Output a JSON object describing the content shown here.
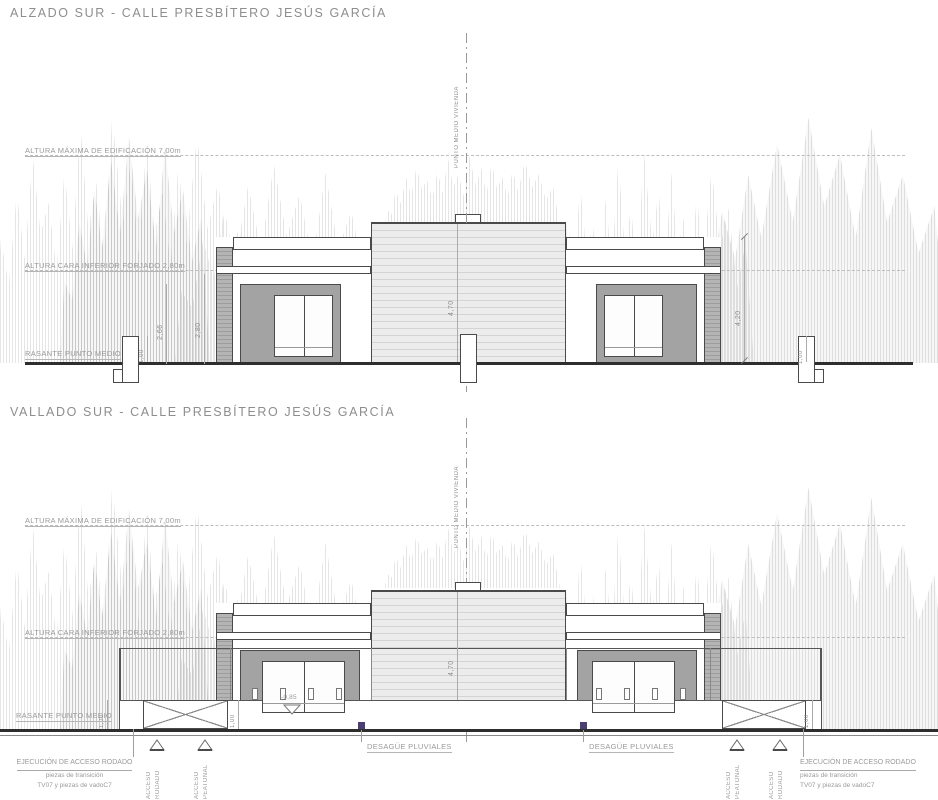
{
  "colors": {
    "line": "#4a4a4a",
    "panel": "#a3a3a3",
    "dim": "#8f8f8f",
    "label": "#9a9a9a",
    "purple": "#4a3e72",
    "ground": "#2e2e2e",
    "dashed": "#bdbdbd"
  },
  "elevation1": {
    "title": "ALZADO SUR - CALLE PRESBÍTERO JESÚS GARCÍA",
    "altura_maxima": "ALTURA MÁXIMA DE EDIFICACIÓN 7,00m",
    "altura_forjado": "ALTURA CARA INFERIOR FORJADO 2,80m",
    "rasante": "RASANTE PUNTO MEDIO",
    "eje": "PUNTO MEDIO VIVIENDA",
    "dims": {
      "wall_a": "2,66",
      "wall_b": "2,80",
      "base_left": "1,00",
      "center": "4,70",
      "right": "4,20",
      "base_right": "1,00"
    }
  },
  "elevation2": {
    "title": "VALLADO SUR - CALLE PRESBÍTERO JESÚS GARCÍA",
    "altura_maxima": "ALTURA MÁXIMA DE EDIFICACIÓN 7,00m",
    "altura_forjado": "ALTURA CARA INFERIOR FORJADO 2,80m",
    "rasante": "RASANTE PUNTO MEDIO",
    "eje": "PUNTO MEDIO VIVIENDA",
    "desague": "DESAGÜE PLUVIALES",
    "acceso_rodado": {
      "w1": "ACCESO",
      "w2": "RODADO"
    },
    "acceso_peatonal": {
      "w1": "ACCESO",
      "w2": "PEATONAL"
    },
    "nota_acceso": {
      "l1": "EJECUCIÓN DE ACCESO RODADO",
      "l2": "piezas de transición",
      "l3": "TV07 y piezas de vadoC7"
    },
    "dims": {
      "rasante": "1,00",
      "gate_left": "1,00",
      "level": "-0,85",
      "center": "4,70",
      "gate_right": "1,00"
    }
  }
}
